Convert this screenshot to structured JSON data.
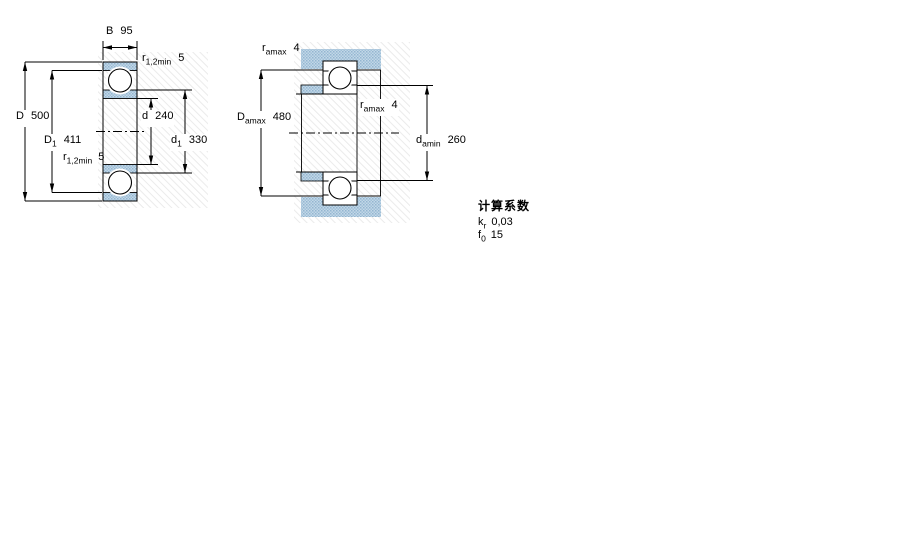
{
  "page": {
    "background": "#ffffff"
  },
  "colors": {
    "line": "#000000",
    "hatch_blue_light": "#c3d7e7",
    "hatch_blue_dark": "#93b6d0",
    "hatch_blue_mid": "#9fc0d8",
    "bg_hatch_line": "#ebebeb"
  },
  "figures": {
    "left": {
      "dims": {
        "B": {
          "sym": "B",
          "sub": "",
          "value": "95"
        },
        "r_top": {
          "sym": "r",
          "sub": "1,2min",
          "value": "5"
        },
        "D": {
          "sym": "D",
          "sub": "",
          "value": "500"
        },
        "D1": {
          "sym": "D",
          "sub": "1",
          "value": "411"
        },
        "r_bottom": {
          "sym": "r",
          "sub": "1,2min",
          "value": "5"
        },
        "d": {
          "sym": "d",
          "sub": "",
          "value": "240"
        },
        "d1": {
          "sym": "d",
          "sub": "1",
          "value": "330"
        }
      }
    },
    "right": {
      "dims": {
        "ra_top": {
          "sym": "r",
          "sub": "amax",
          "value": "4"
        },
        "Da": {
          "sym": "D",
          "sub": "amax",
          "value": "480"
        },
        "ra_mid": {
          "sym": "r",
          "sub": "amax",
          "value": "4"
        },
        "da": {
          "sym": "d",
          "sub": "amin",
          "value": "260"
        }
      }
    }
  },
  "calculation": {
    "title": "计算系数",
    "rows": [
      {
        "sym": "k",
        "sub": "r",
        "value": "0,03"
      },
      {
        "sym": "f",
        "sub": "0",
        "value": "15"
      }
    ]
  }
}
